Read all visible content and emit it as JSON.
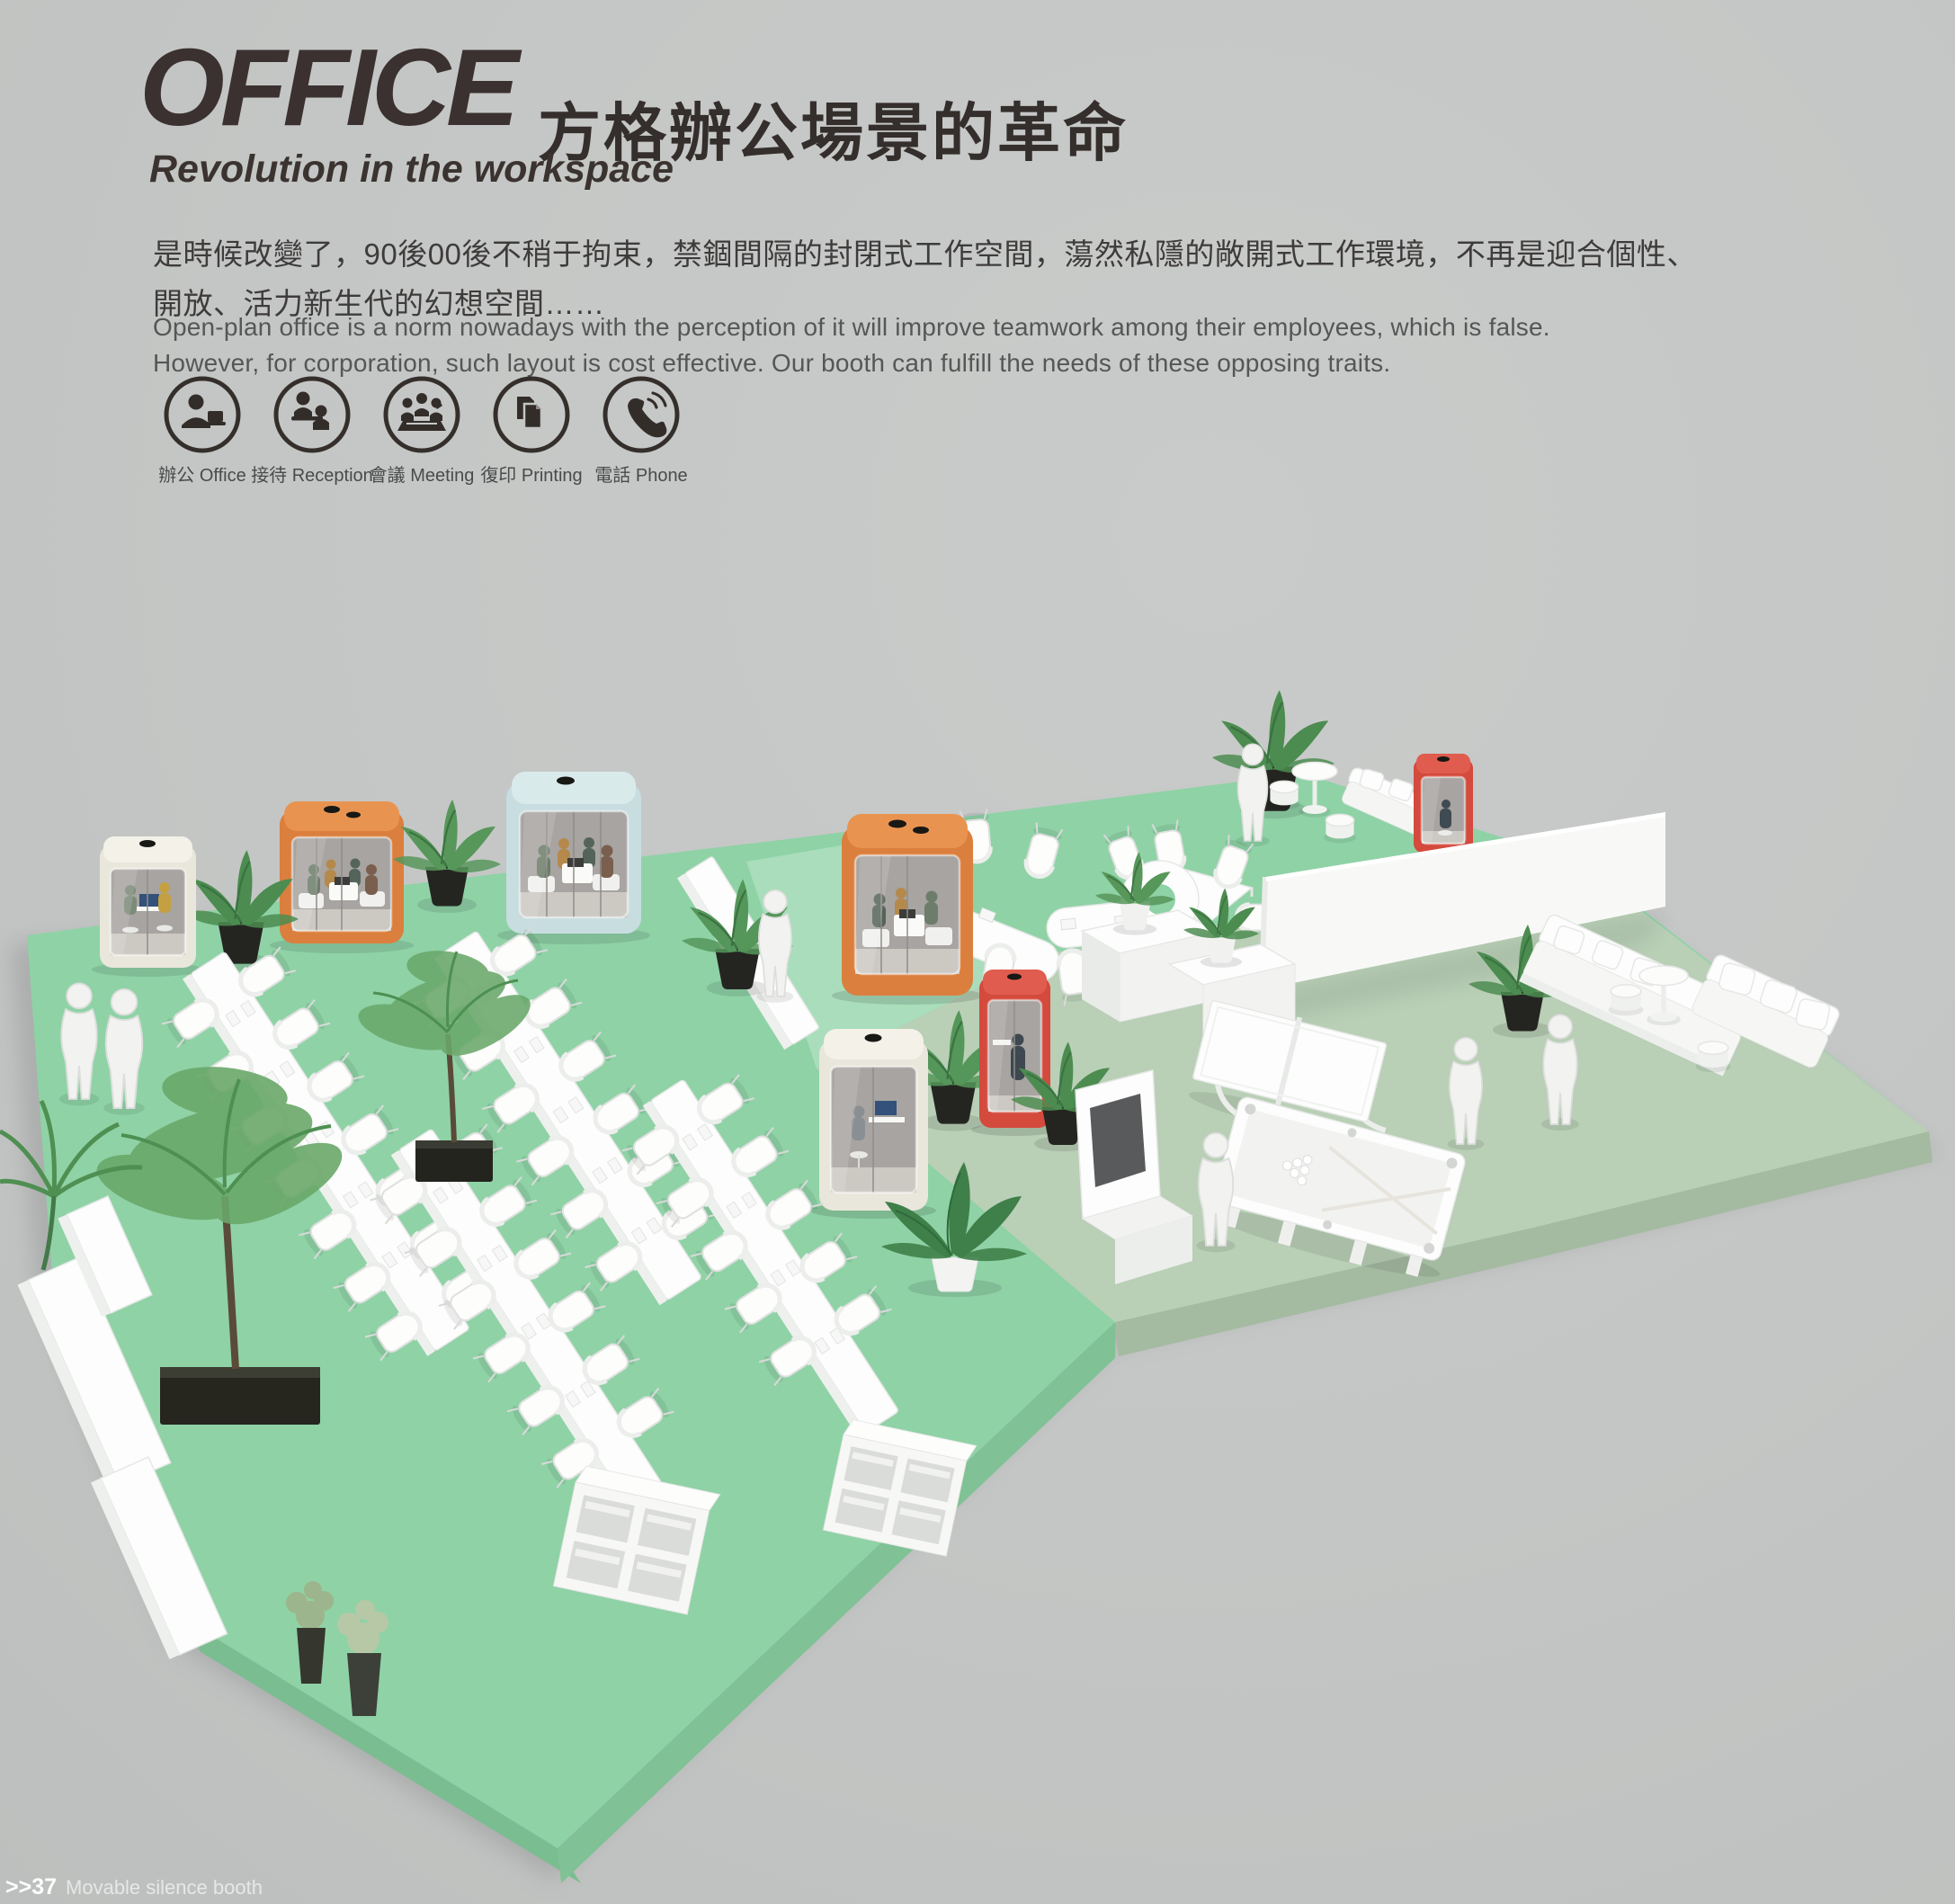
{
  "header": {
    "title": "OFFICE",
    "title_cn": "方格辦公場景的革命",
    "subtitle": "Revolution in the workspace"
  },
  "intro": {
    "cn_line1": "是時候改變了，90後00後不稍于拘束，禁錮間隔的封閉式工作空間，蕩然私隱的敞開式工作環境，不再是迎合個性、",
    "cn_line2": "開放、活力新生代的幻想空間……",
    "en_line1": "Open-plan office is a norm nowadays with the perception of it will improve teamwork among their employees, which is false.",
    "en_line2": "However, for corporation, such layout is cost effective. Our booth can fulfill the needs of these opposing traits."
  },
  "features": [
    {
      "label": "辦公 Office",
      "icon": "office-icon"
    },
    {
      "label": "接待 Reception",
      "icon": "reception-icon"
    },
    {
      "label": "會議 Meeting",
      "icon": "meeting-icon"
    },
    {
      "label": "復印 Printing",
      "icon": "printing-icon"
    },
    {
      "label": "電話 Phone",
      "icon": "phone-icon"
    }
  ],
  "footer": {
    "index": ">>37",
    "label": "Movable silence booth"
  },
  "colors": {
    "background": "#c4c6c5",
    "title_text": "#3a3130",
    "body_text": "#4a4a4a",
    "icon_stroke": "#352f2c",
    "floor_mint": "#8fd2a6",
    "floor_mint_light": "#a9ddbb",
    "floor_sage": "#b9cfb6",
    "booth_orange": "#db7f3e",
    "booth_red": "#d44a3d",
    "booth_blue": "#c8dde0",
    "booth_cream": "#e9e6db"
  }
}
